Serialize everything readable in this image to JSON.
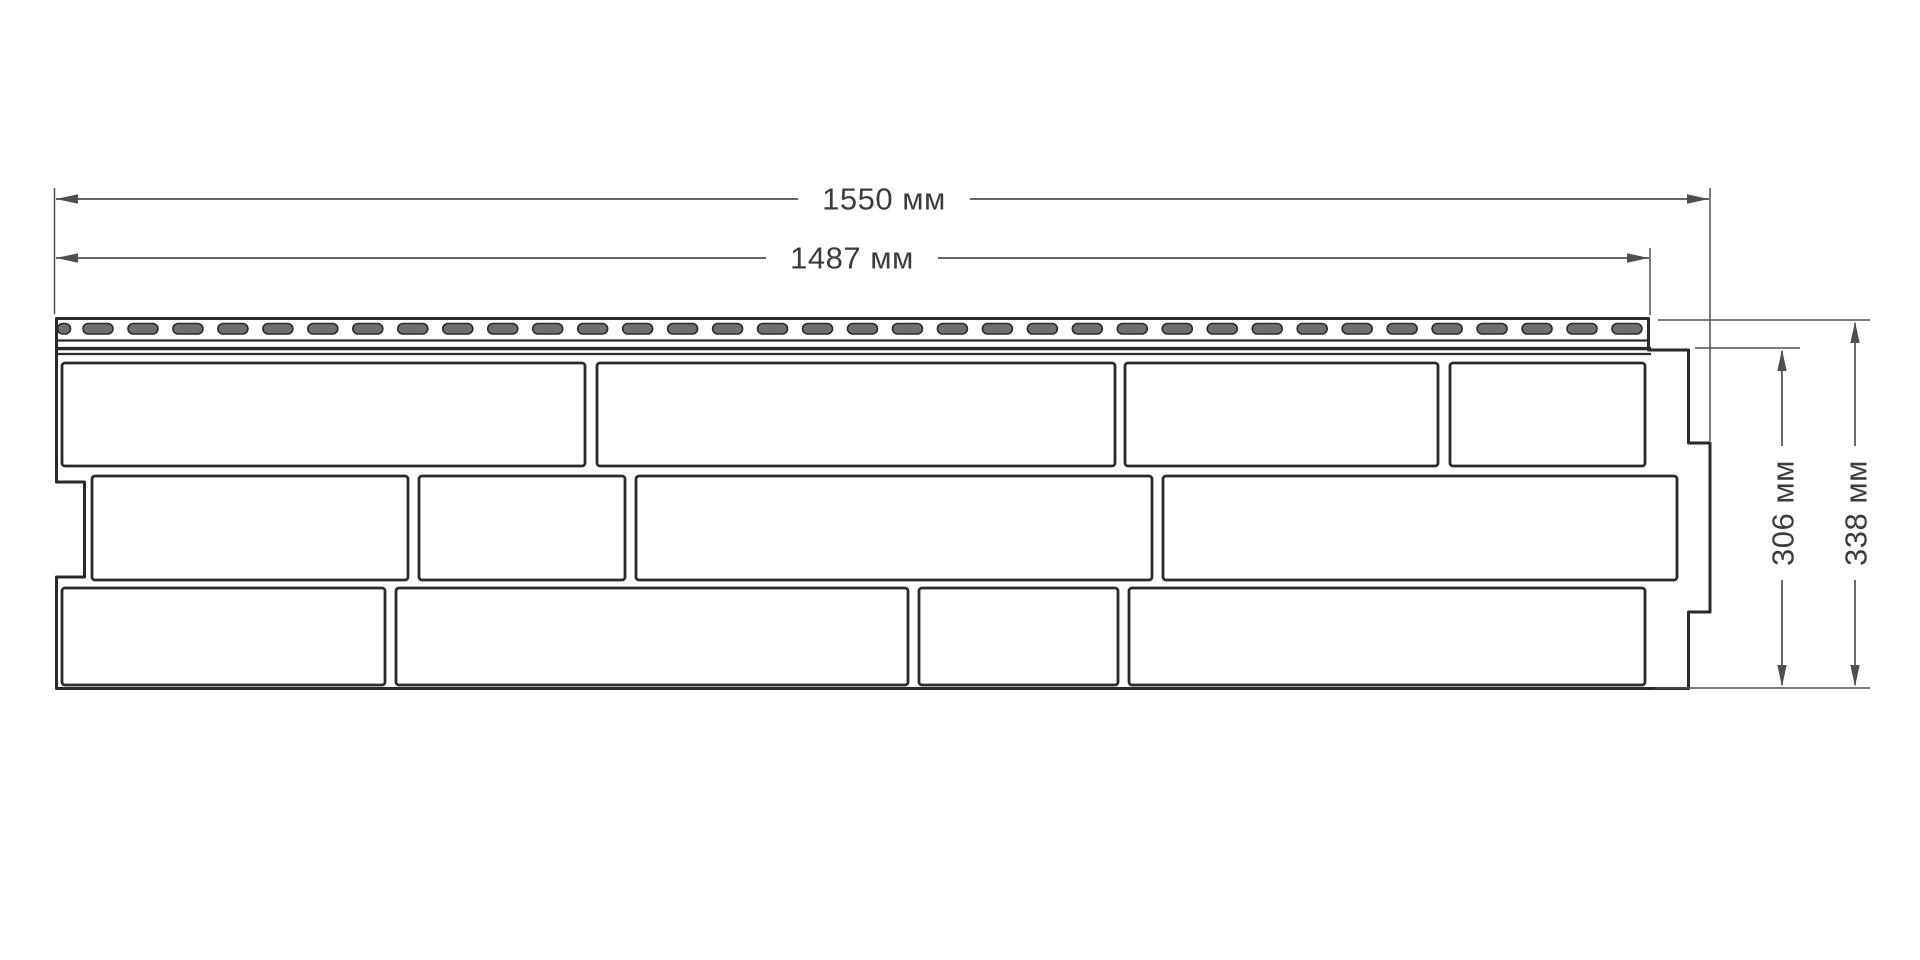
{
  "colors": {
    "background": "#ffffff",
    "line": "#2a2a2a",
    "dim_line": "#4f4f4f",
    "dim_text": "#3c3c3c",
    "slot_fill": "#6f6f6f"
  },
  "diagram": {
    "dimensions": {
      "width_total": {
        "label": "1550 мм",
        "value": 1550,
        "unit": "мм"
      },
      "width_useful": {
        "label": "1487 мм",
        "value": 1487,
        "unit": "мм"
      },
      "height_useful": {
        "label": "306 мм",
        "value": 306,
        "unit": "мм"
      },
      "height_total": {
        "label": "338 мм",
        "value": 338,
        "unit": "мм"
      }
    },
    "panel": {
      "nail_slots": {
        "partial": {
          "x": 57.5,
          "w": 13
        },
        "count": 35,
        "start_x": 83,
        "pitch": 44.97,
        "width": 30,
        "y": 323.5,
        "height": 10.5
      },
      "brick_rows": [
        {
          "y": 363,
          "h": 103,
          "bricks": [
            [
              62,
              523
            ],
            [
              597,
              518
            ],
            [
              1125,
              313
            ],
            [
              1450,
              195
            ]
          ]
        },
        {
          "y": 476,
          "h": 104,
          "bricks": [
            [
              92,
              316
            ],
            [
              419,
              206
            ],
            [
              636,
              516
            ],
            [
              1163,
              514
            ]
          ]
        },
        {
          "y": 588,
          "h": 97,
          "bricks": [
            [
              62,
              323
            ],
            [
              396,
              512
            ],
            [
              919,
              199
            ],
            [
              1129,
              516
            ]
          ]
        }
      ]
    }
  }
}
